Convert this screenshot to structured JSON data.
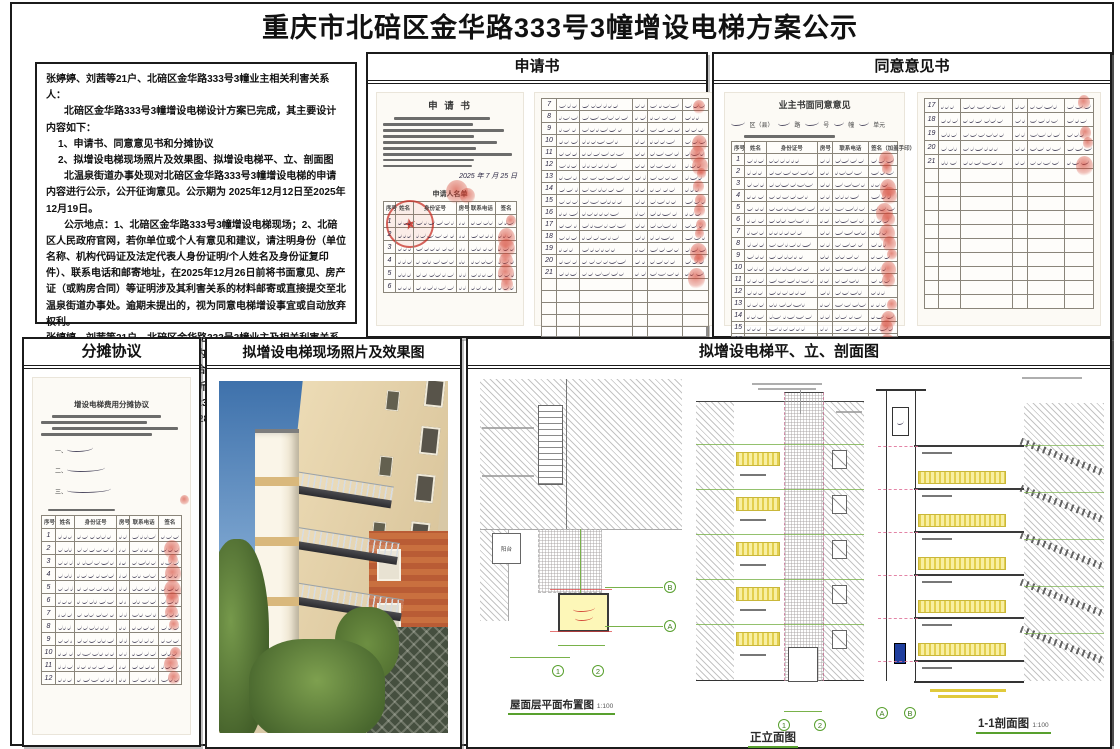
{
  "page": {
    "title": "重庆市北碚区金华路333号3幢增设电梯方案公示"
  },
  "colors": {
    "fingerprint_red": "#d33e2d",
    "stamp_red": "#c62c22",
    "dimension_green": "#58a02e",
    "louver_yellow": "#f2e27a",
    "shaft_highlight_yellow": "#fdf7b8",
    "border_black": "#1b1b1b"
  },
  "notice": {
    "salutation": "张婷婷、刘茜等21户、北碚区金华路333号3幢业主相关利害关系人：",
    "paragraphs": [
      "北碚区金华路333号3幢增设电梯设计方案已完成，其主要设计内容如下：",
      "1、申请书、同意意见书和分摊协议",
      "2、拟增设电梯现场照片及效果图、拟增设电梯平、立、剖面图",
      "北温泉街道办事处现对北碚区金华路333号3幢增设电梯的申请内容进行公示，公开征询意见。公示期为 2025年12月12日至2025年12月19日。",
      "公示地点：1、北碚区金华路333号3幢增设电梯现场；2、北碚区人民政府官网，若你单位或个人有意见和建议，请注明身份（单位名称、机构代码证及法定代表人身份证明/个人姓名及身份证复印件）、联系电话和邮寄地址，在2025年12月26日前将书面意见、房产证（或购房合同）等证明涉及其利害关系的材料邮寄或直接提交至北温泉街道办事处。逾期未提出的，视为同意电梯增设事宜或自动放弃权利。",
      "张婷婷、刘茜等21户、北碚区金华路333号3幢业主及相关利害关系人可自公示期满之日起五个工作日内，向北温泉街道办事处提出书面听证申请，并提交房产证（或购房合同）等证明涉及其利害关系的材料。逾期未提出的，视为自动放弃听证权利。",
      "联系人：罗老师，联系电话： 023-68357583",
      "联系地址：重庆市北碚区北泉路289号，邮政编码：400700"
    ]
  },
  "panels": {
    "application": {
      "header": "申请书",
      "doc_title": "申 请 书",
      "sign_date": "2025 年 7 月 25 日",
      "list_title": "申请人名单"
    },
    "consent": {
      "header": "同意意见书",
      "doc_title": "业主书面同意意见",
      "fill_fragments": [
        "区（县）",
        "路",
        "号",
        "幢",
        "单元"
      ]
    },
    "sharing": {
      "header": "分摊协议",
      "doc_title": "增设电梯费用分摊协议",
      "list_markers": [
        "一、",
        "二、",
        "三、"
      ]
    },
    "photo": {
      "header": "拟增设电梯现场照片及效果图"
    },
    "drawings": {
      "header": "拟增设电梯平、立、剖面图",
      "plan": {
        "caption": "屋面层平面布置图",
        "scale": "1:100",
        "balcony_label": "阳台"
      },
      "elevation": {
        "caption": "正立面图"
      },
      "section": {
        "caption": "1-1剖面图",
        "scale": "1:100"
      },
      "grid": {
        "g1": "1",
        "g2": "2",
        "ga": "A",
        "gb": "B"
      }
    }
  },
  "tables": {
    "application_left": {
      "seed": 11,
      "row_h": 12,
      "cols": [
        9,
        14,
        32,
        9,
        21,
        15
      ],
      "header_labels": [
        "序号",
        "姓名",
        "身份证号",
        "房号",
        "联系电话",
        "签名"
      ],
      "rows": [
        "1",
        "2",
        "3",
        "4",
        "5",
        "6"
      ],
      "empty_rows": 0,
      "fp_prob": 0.95
    },
    "application_right": {
      "seed": 23,
      "row_h": 11,
      "cols": [
        9,
        14,
        32,
        9,
        21,
        15
      ],
      "rows": [
        "7",
        "8",
        "9",
        "10",
        "11",
        "12",
        "13",
        "14",
        "15",
        "16",
        "17",
        "18",
        "19",
        "20",
        "21"
      ],
      "empty_rows": 5,
      "fp_prob": 0.85
    },
    "consent_left": {
      "seed": 31,
      "row_h": 11,
      "cols": [
        8,
        13,
        31,
        9,
        22,
        17
      ],
      "header_labels": [
        "序号",
        "姓名",
        "身份证号",
        "房号",
        "联系电话",
        "签名（加盖手印）"
      ],
      "rows": [
        "1",
        "2",
        "3",
        "4",
        "5",
        "6",
        "7",
        "8",
        "9",
        "10",
        "11",
        "12",
        "13",
        "14",
        "15",
        "16"
      ],
      "empty_rows": 0,
      "fp_prob": 0.9
    },
    "consent_right": {
      "seed": 41,
      "row_h": 13,
      "cols": [
        8,
        13,
        31,
        9,
        22,
        17
      ],
      "rows": [
        "17",
        "18",
        "19",
        "20",
        "21"
      ],
      "empty_rows": 10,
      "fp_prob": 0.9
    },
    "sharing_table": {
      "seed": 51,
      "row_h": 12,
      "cols": [
        10,
        14,
        30,
        9,
        21,
        16
      ],
      "header_labels": [
        "序号",
        "姓名",
        "身份证号",
        "房号",
        "联系电话",
        "签名"
      ],
      "rows": [
        "1",
        "2",
        "3",
        "4",
        "5",
        "6",
        "7",
        "8",
        "9",
        "10",
        "11",
        "12"
      ],
      "empty_rows": 0,
      "fp_prob": 0.9
    }
  }
}
